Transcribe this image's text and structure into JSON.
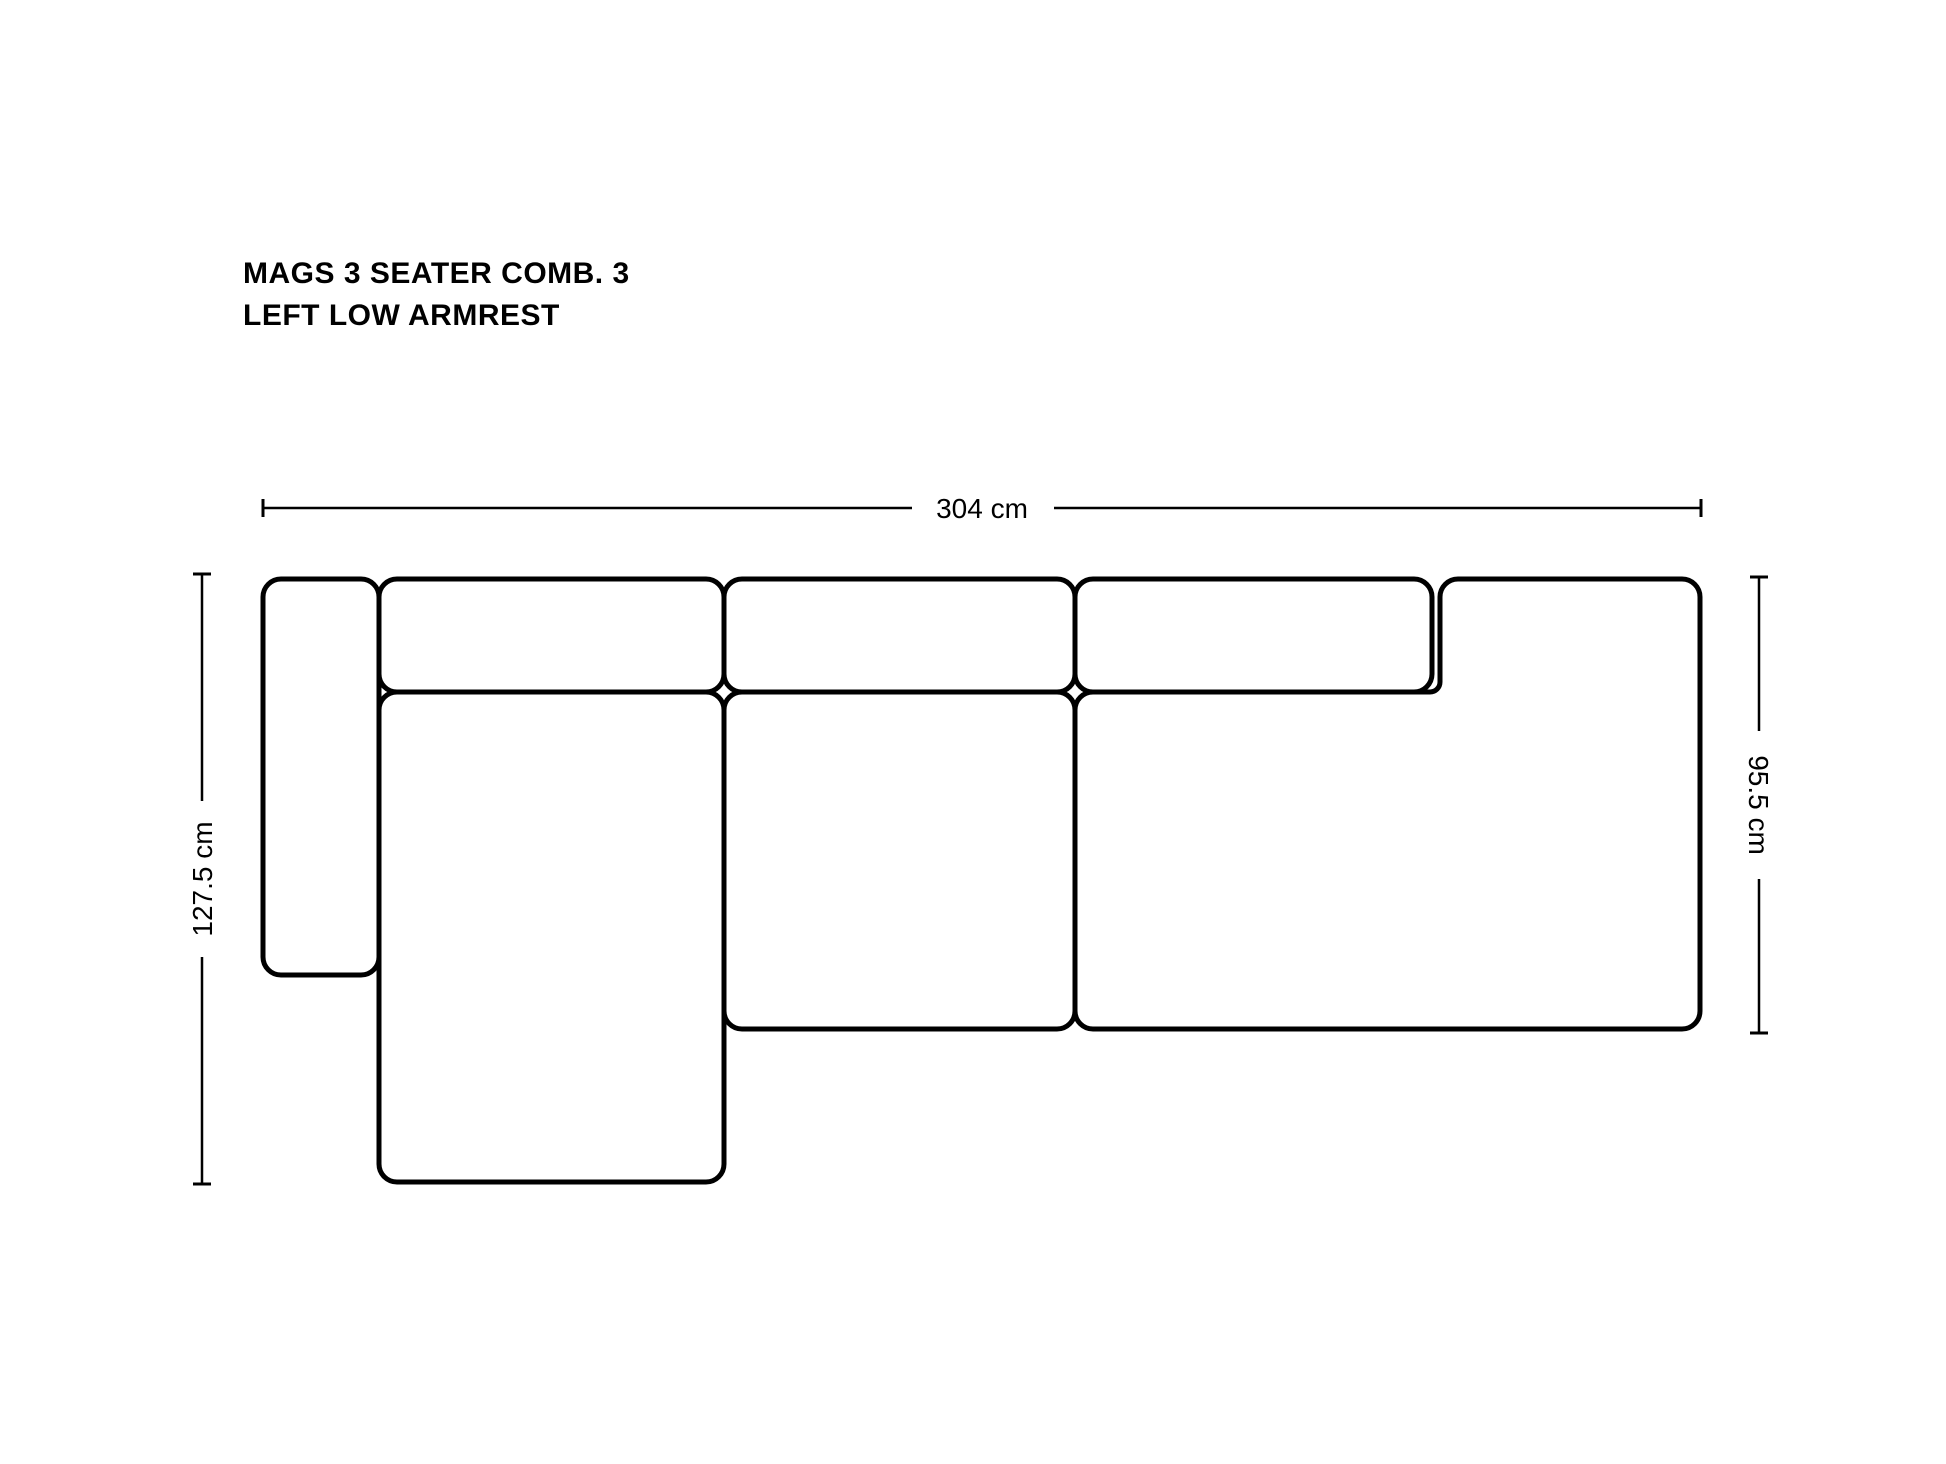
{
  "title": {
    "line1": "MAGS 3 SEATER COMB. 3",
    "line2": "LEFT LOW ARMREST"
  },
  "dimensions": {
    "overall_width": "304 cm",
    "overall_depth_left": "127.5 cm",
    "right_side_depth": "95.5 cm"
  },
  "colors": {
    "line": "#000000",
    "text": "#000000",
    "background": "#ffffff"
  }
}
